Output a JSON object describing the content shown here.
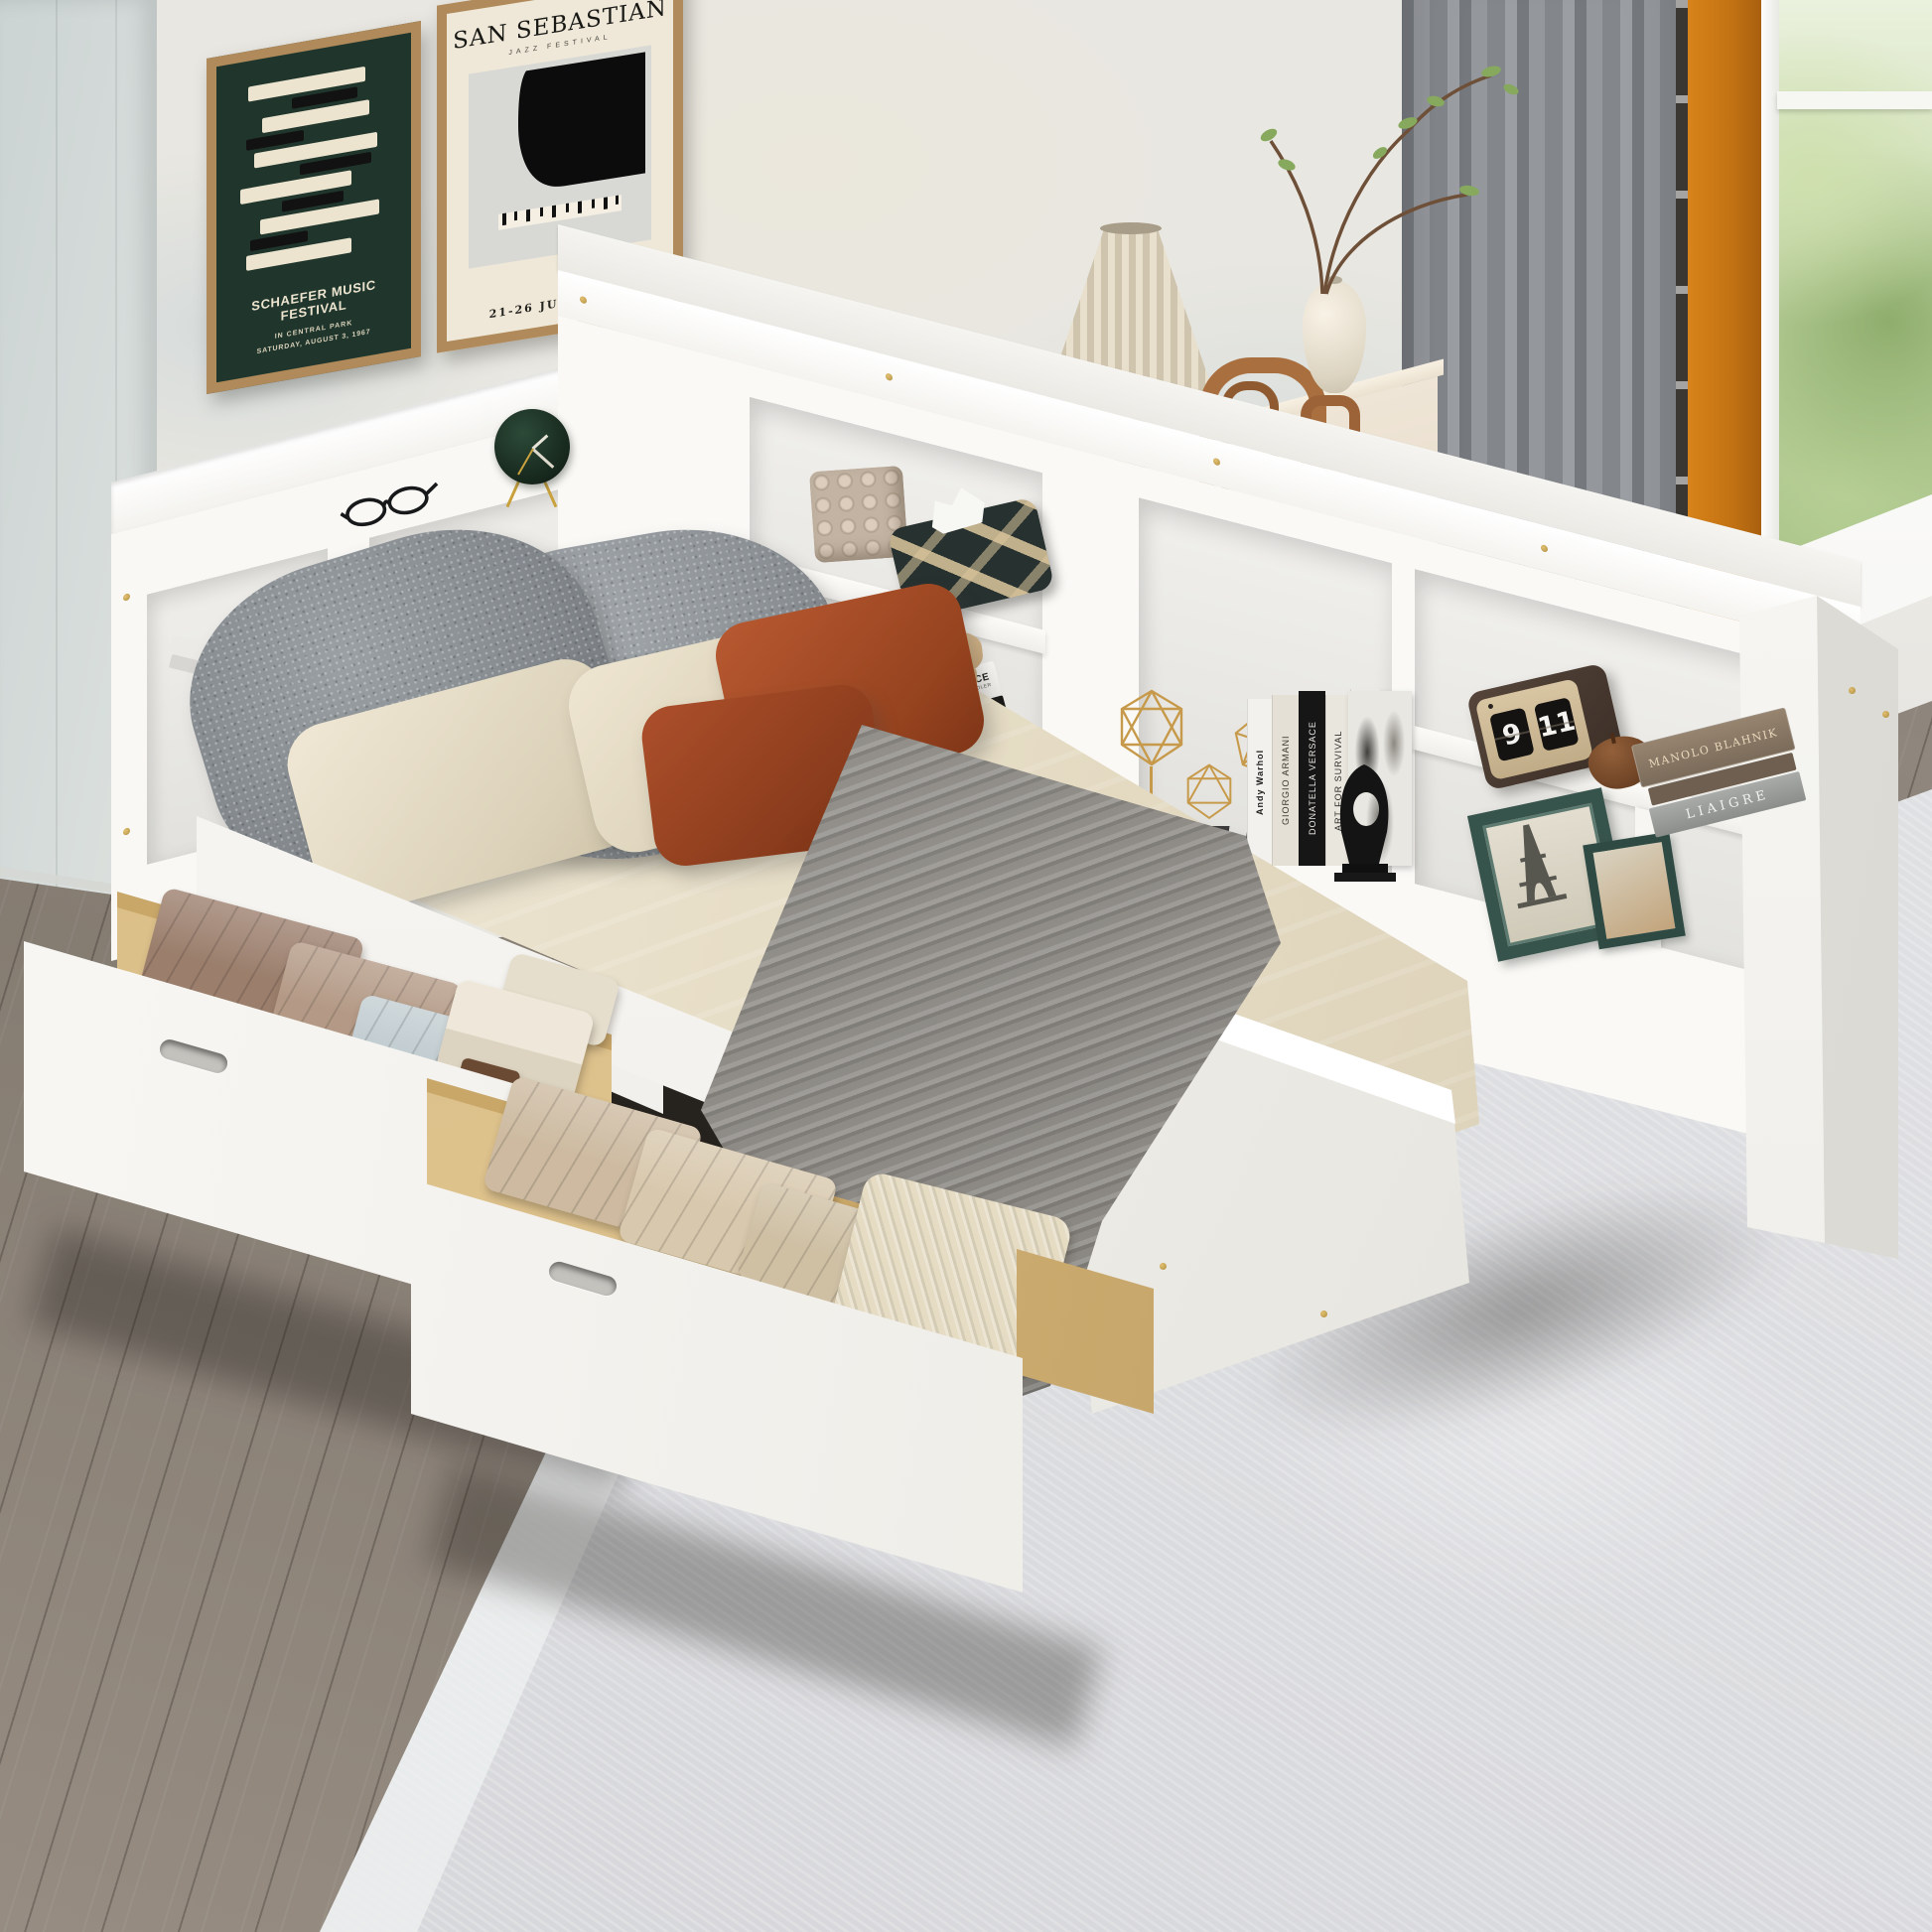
{
  "posters": {
    "music": {
      "title": "SCHAEFER MUSIC FESTIVAL",
      "line2": "IN CENTRAL PARK",
      "line3": "SATURDAY, AUGUST 3, 1967",
      "bg": "#20362c"
    },
    "jazz": {
      "title": "SAN SEBASTIAN",
      "subtitle": "JAZZ FESTIVAL",
      "date": "21-26 JULIO 2000",
      "bg": "#efe8d8"
    }
  },
  "shelf": {
    "flip_clock": {
      "hour": "9",
      "minute": "11"
    },
    "book_spines": [
      "Andy Warhol",
      "GIORGIO ARMANI",
      "DONATELLA VERSACE",
      "ART FOR SURVIVAL",
      "MEN'S STYLE STORIES"
    ],
    "book_stack": {
      "top": "MANOLO BLAHNIK",
      "bottom": "LIAIGRE"
    },
    "finance_book": {
      "title": "R FINANCE",
      "author": "RAYMOND CHANDLER"
    }
  },
  "objects": [
    "framed-poster-music",
    "framed-poster-jazz",
    "reading-glasses",
    "green-desk-clock",
    "bubble-candle",
    "woven-tissue-box",
    "elephant-figurine",
    "gold-wire-sculptures",
    "fashion-books",
    "black-abstract-sculpture",
    "flip-clock",
    "wooden-trinket-box",
    "photo-frame-eiffel-tower",
    "photo-frame-small",
    "book-stack",
    "table-lamp",
    "arch-ornament",
    "vase-with-branches",
    "dresser",
    "curtain",
    "window",
    "storage-bed-with-bookcase-headboard",
    "pull-out-drawers",
    "folded-clothes",
    "knit-throw",
    "area-rug"
  ],
  "palette": {
    "wall": "#e8e6e0",
    "left_wall": "#cfd6d5",
    "floor_wood": "#8d847b",
    "rug": "#e0e1e3",
    "bed_white": "#f8f7f4",
    "poster_green": "#20362c",
    "poster_cream": "#efe8d8",
    "curtain_gray": "#84878c",
    "pillar_orange": "#c97716",
    "drawer_wood": "#dcc08a",
    "pillow_gray": "#8d9296",
    "pillow_beige": "#e7dfcc",
    "pillow_rust": "#a64a2a",
    "throw_gray": "#8d8a85",
    "gold_hardware": "#c9a23e",
    "greenery": "#9cb97c"
  }
}
